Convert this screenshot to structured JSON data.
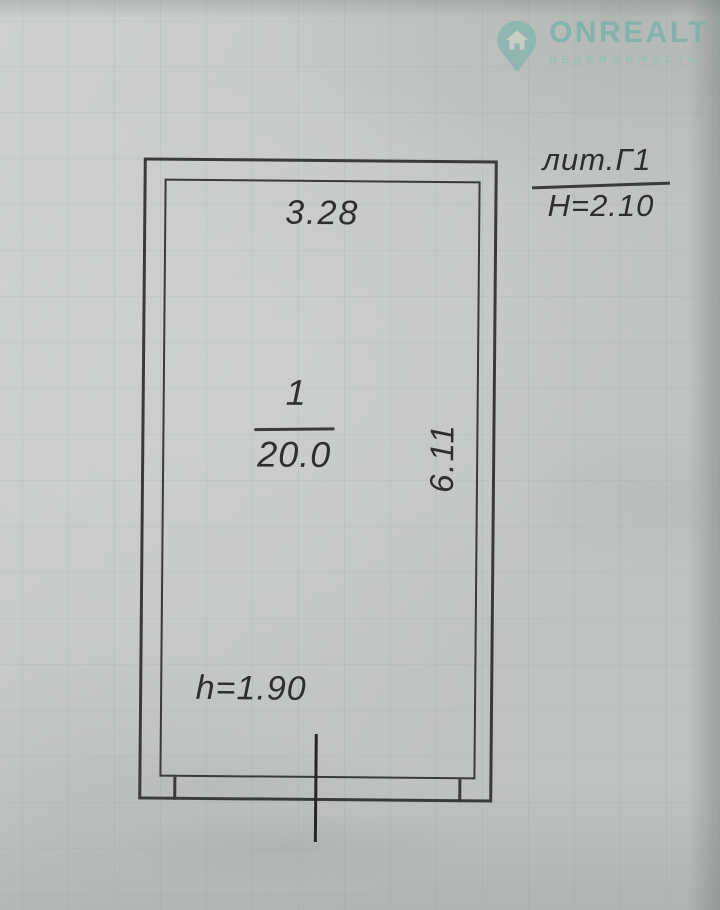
{
  "watermark": {
    "brand": "ONREALT",
    "subtitle": "НЕДВИЖИМОСТЬ",
    "brand_color": "#7db2aa"
  },
  "plan": {
    "litera_label": "лит.Г1",
    "building_height": "H=2.10",
    "width_dimension": "3.28",
    "room_number": "1",
    "room_area": "20.0",
    "depth_dimension": "6.11",
    "ceiling_height": "h=1.90"
  }
}
